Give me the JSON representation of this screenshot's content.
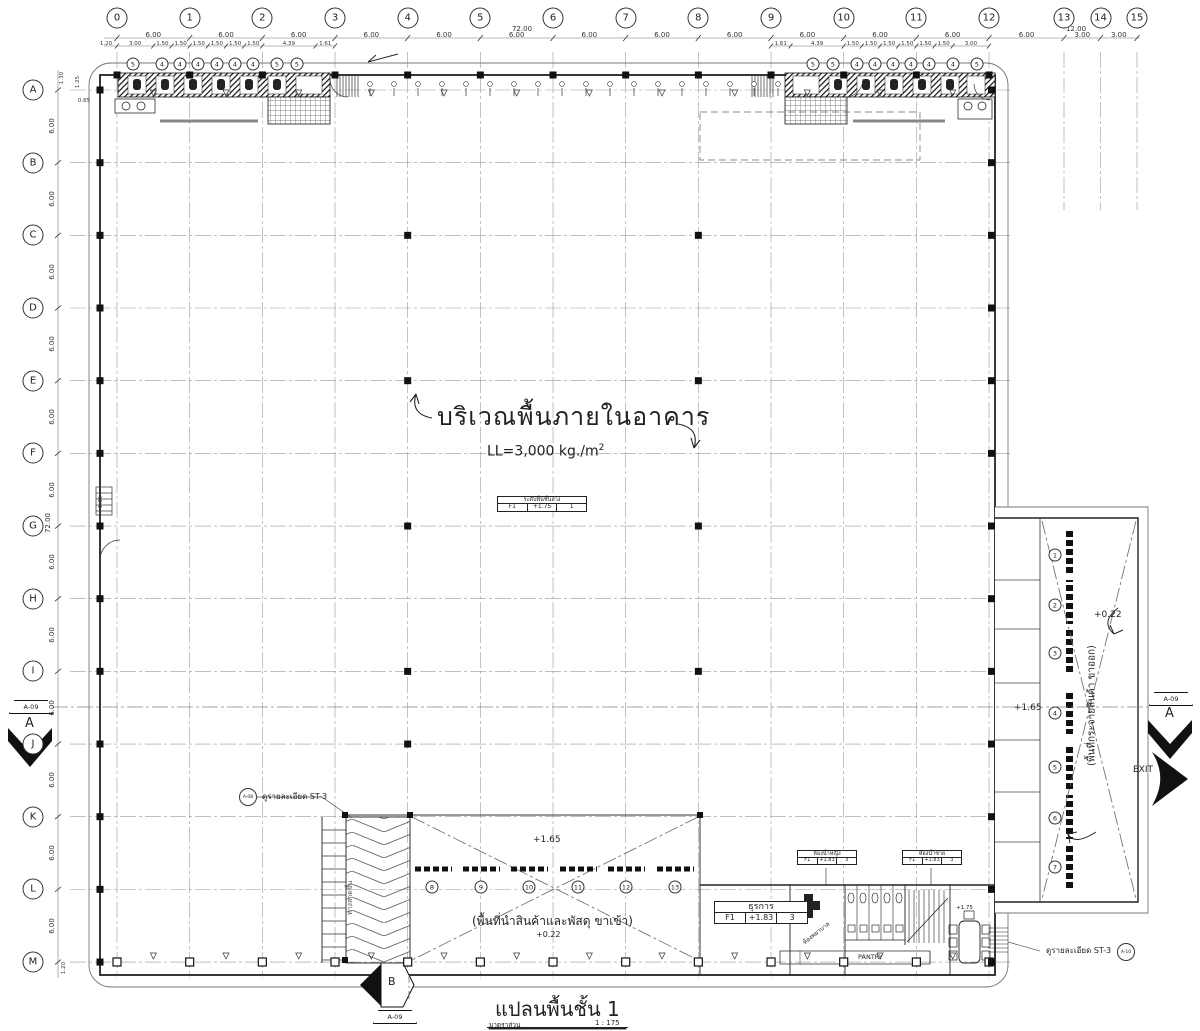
{
  "title_block": {
    "title": "แปลนพื้นชั้น 1",
    "scale_label": "มาตราส่วน",
    "scale_value": "1 : 175"
  },
  "grid": {
    "columns": [
      "0",
      "1",
      "2",
      "3",
      "4",
      "5",
      "6",
      "7",
      "8",
      "9",
      "10",
      "11",
      "12",
      "13",
      "14",
      "15"
    ],
    "rows": [
      "A",
      "B",
      "C",
      "D",
      "E",
      "F",
      "G",
      "H",
      "I",
      "J",
      "K",
      "L",
      "M"
    ],
    "top_gap_dims": [
      "6.00",
      "6.00",
      "6.00",
      "6.00",
      "6.00",
      "6.00",
      "6.00",
      "6.00",
      "6.00",
      "6.00",
      "6.00",
      "6.00",
      "6.00",
      "3.00",
      "3.00"
    ],
    "top_overall": "72.00",
    "top_right_overall": "12.00",
    "left_gap_dims": [
      "6.00",
      "6.00",
      "6.00",
      "6.00",
      "6.00",
      "6.00",
      "6.00",
      "6.00",
      "6.00",
      "6.00",
      "6.00",
      "6.00"
    ],
    "left_overall": "72.00",
    "left_subdims": [
      "3.00",
      "1.50",
      "1.50",
      "1.50",
      "1.50",
      "1.50",
      "1.50",
      "4.39",
      "1.61"
    ],
    "right_subdims": [
      "1.61",
      "4.39",
      "1.50",
      "1.50",
      "1.50",
      "1.50",
      "1.50",
      "1.50",
      "3.00"
    ],
    "edge_left_top": "1.20",
    "edge_left_bottom": "1.20",
    "edge_a_1": "1.30",
    "edge_a_2": "1.25",
    "edge_a_3": "0.65",
    "edge_g": "1.65"
  },
  "annotations": {
    "main_area_title": "บริเวณพื้นภายในอาคาร",
    "load_prefix": "LL=3,000  kg./m",
    "load_sup": "2",
    "floor_level_box": {
      "title": "ระดับพื้นชั้นล่าง",
      "tag": "F1",
      "value": "+1.75",
      "num": "1"
    },
    "receiving_area_label": "(พื้นที่นำสินค้าและพัสดุ ขาเข้า)",
    "receiving_level_upper": "+1.65",
    "receiving_level_lower": "+0.22",
    "dispatch_area_label": "(พื้นที่กระจายสินค้า ขาออก)",
    "dispatch_level_upper": "+0.22",
    "dispatch_level_mid": "+1.65",
    "exit_label": "EXIT",
    "ramp_note": "ดูรายละเอียด ST-3",
    "ramp_note_ref": "A-08",
    "stair_note": "ดูรายละเอียด ST-3",
    "stair_note_ref": "A-10",
    "ramp_label": "ทางลาดขึ้น",
    "pantry_label": "PANTRY",
    "first_aid_label": "ห้องพยาบาล",
    "stair_level": "+1.75",
    "office_box": {
      "name": "ธุรการ",
      "tag": "F1",
      "value": "+1.83",
      "num": "3"
    },
    "toilet_female_box": {
      "name": "ห้องน้ำหญิง",
      "tag": "F1",
      "value": "+1.83",
      "num": "3"
    },
    "toilet_male_box": {
      "name": "ห้องน้ำชาย",
      "tag": "F1",
      "value": "+1.83",
      "num": "3"
    }
  },
  "section_markers": {
    "sheet_ref": "A-09",
    "left_letter": "A",
    "right_letter": "A",
    "bottom_letter": "B"
  },
  "callouts": {
    "top_left_fixtures": [
      "5",
      "4",
      "4",
      "4",
      "4",
      "4",
      "4",
      "5",
      "5"
    ],
    "top_right_fixtures": [
      "5",
      "5",
      "4",
      "4",
      "4",
      "4",
      "4",
      "4",
      "5"
    ],
    "bottom_dock_numbers": [
      "8",
      "9",
      "10",
      "11",
      "12",
      "13"
    ],
    "wing_dock_numbers": [
      "1",
      "2",
      "3",
      "4",
      "5",
      "6",
      "7"
    ]
  },
  "colors": {
    "line": "#444",
    "wall": "#111",
    "grid": "#999"
  }
}
